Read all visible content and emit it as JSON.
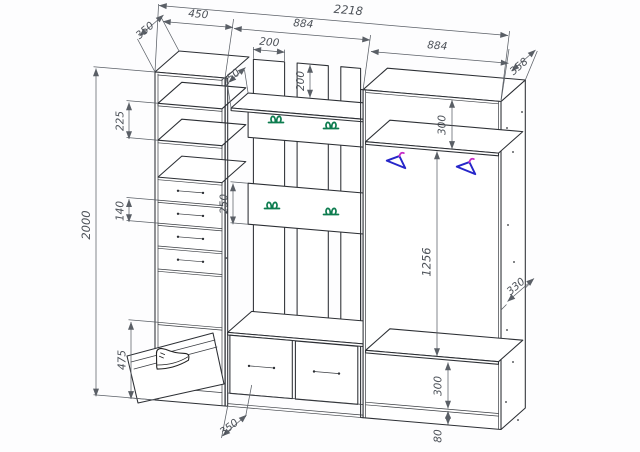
{
  "dims": {
    "left_depth": "350",
    "left_width": "450",
    "total_width": "2218",
    "middle_width": "884",
    "right_width": "884",
    "right_depth": "358",
    "top_shelf_depth": "250",
    "slat_width": "200",
    "slat_upstand": "200",
    "shelf_gap": "225",
    "left_height": "2000",
    "drawer_height": "140",
    "shoe_cabinet_height": "475",
    "hook_rail_height": "250",
    "bench_depth": "350",
    "wardrobe_top_gap": "300",
    "hanging_height": "1256",
    "wardrobe_side_depth": "330",
    "wardrobe_bottom_gap": "300",
    "plinth_height": "80"
  },
  "colors": {
    "background": "#ffffff",
    "line": "#2c2f34",
    "dimension": "#5a5f66",
    "coat_hook": "#0d7c4f",
    "hanger": "#2626c9",
    "hanger_hook": "#c62ac6"
  }
}
